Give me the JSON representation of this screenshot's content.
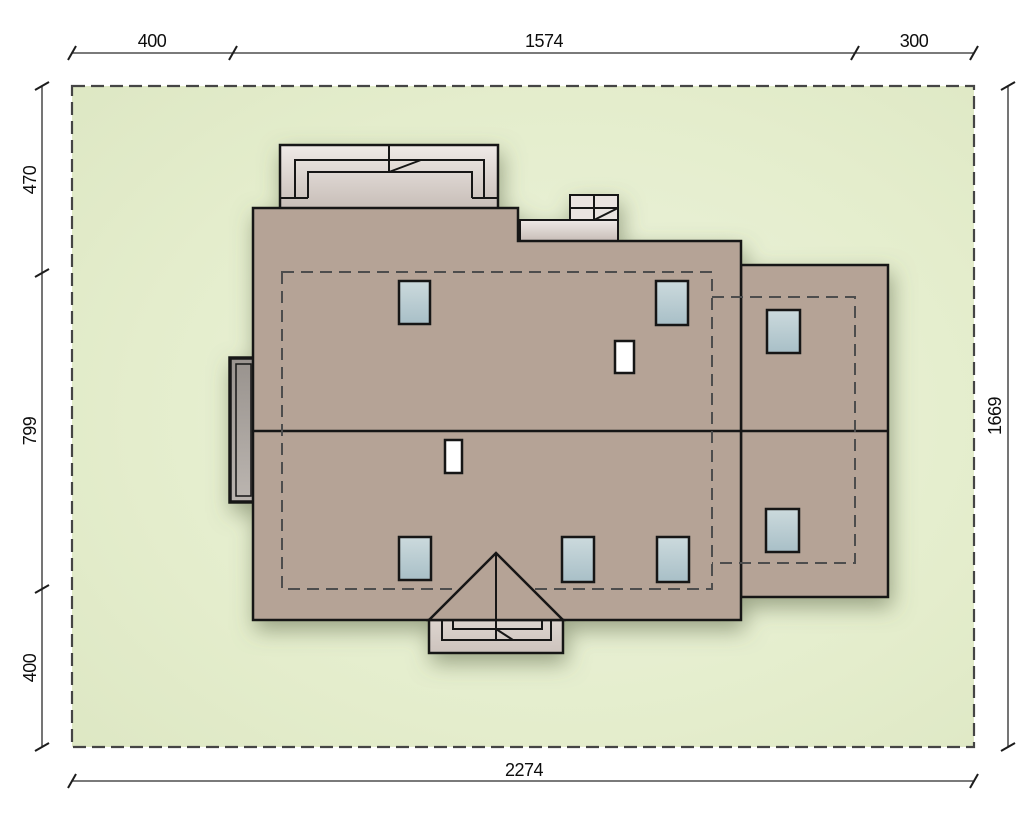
{
  "drawing": {
    "kind": "house-site-plan-top-view",
    "dimensions": {
      "top": {
        "segments": [
          "400",
          "1574",
          "300"
        ]
      },
      "left": {
        "segments": [
          "470",
          "799",
          "400"
        ]
      },
      "right": {
        "total": "1669"
      },
      "bottom": {
        "total": "2274"
      }
    },
    "colors": {
      "roof": "#b5a396",
      "plot_green": "#e4edcc",
      "skylight": "#bccfd6",
      "outline": "#151515",
      "dashed_wall": "#4e4e4e"
    },
    "legend": {
      "plot": "plot boundary (dashed)",
      "main_roof": "main house roof",
      "garage_roof": "garage wing roof",
      "skylights": 7,
      "chimneys": 2
    }
  }
}
